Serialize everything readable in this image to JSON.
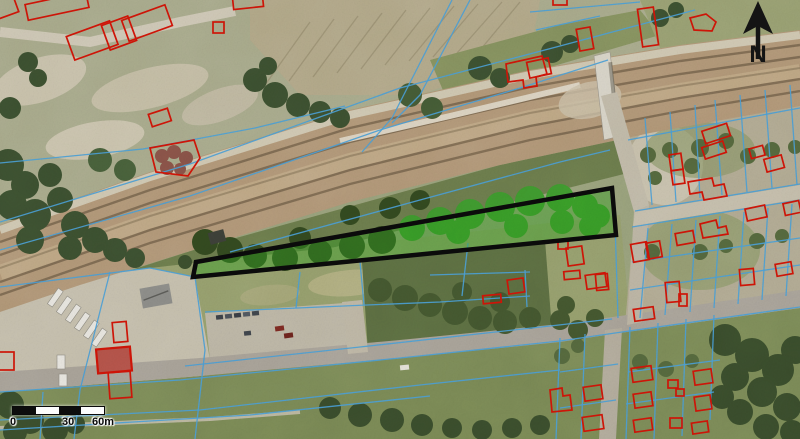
{
  "map": {
    "north_arrow": {
      "label": "N"
    },
    "scale_bar": {
      "labels": [
        "0",
        "30",
        "60m"
      ],
      "segments": 4
    },
    "overlay_colors": {
      "building-outline": "#d01407",
      "parcel-line": "#4a9ed6",
      "subject-outline": "#0a0a0a",
      "subject-fill": "#2fa01f",
      "subject-fill-opacity": "0.42",
      "marker-black": "#141414",
      "label-color": "#0a0a0a"
    }
  }
}
